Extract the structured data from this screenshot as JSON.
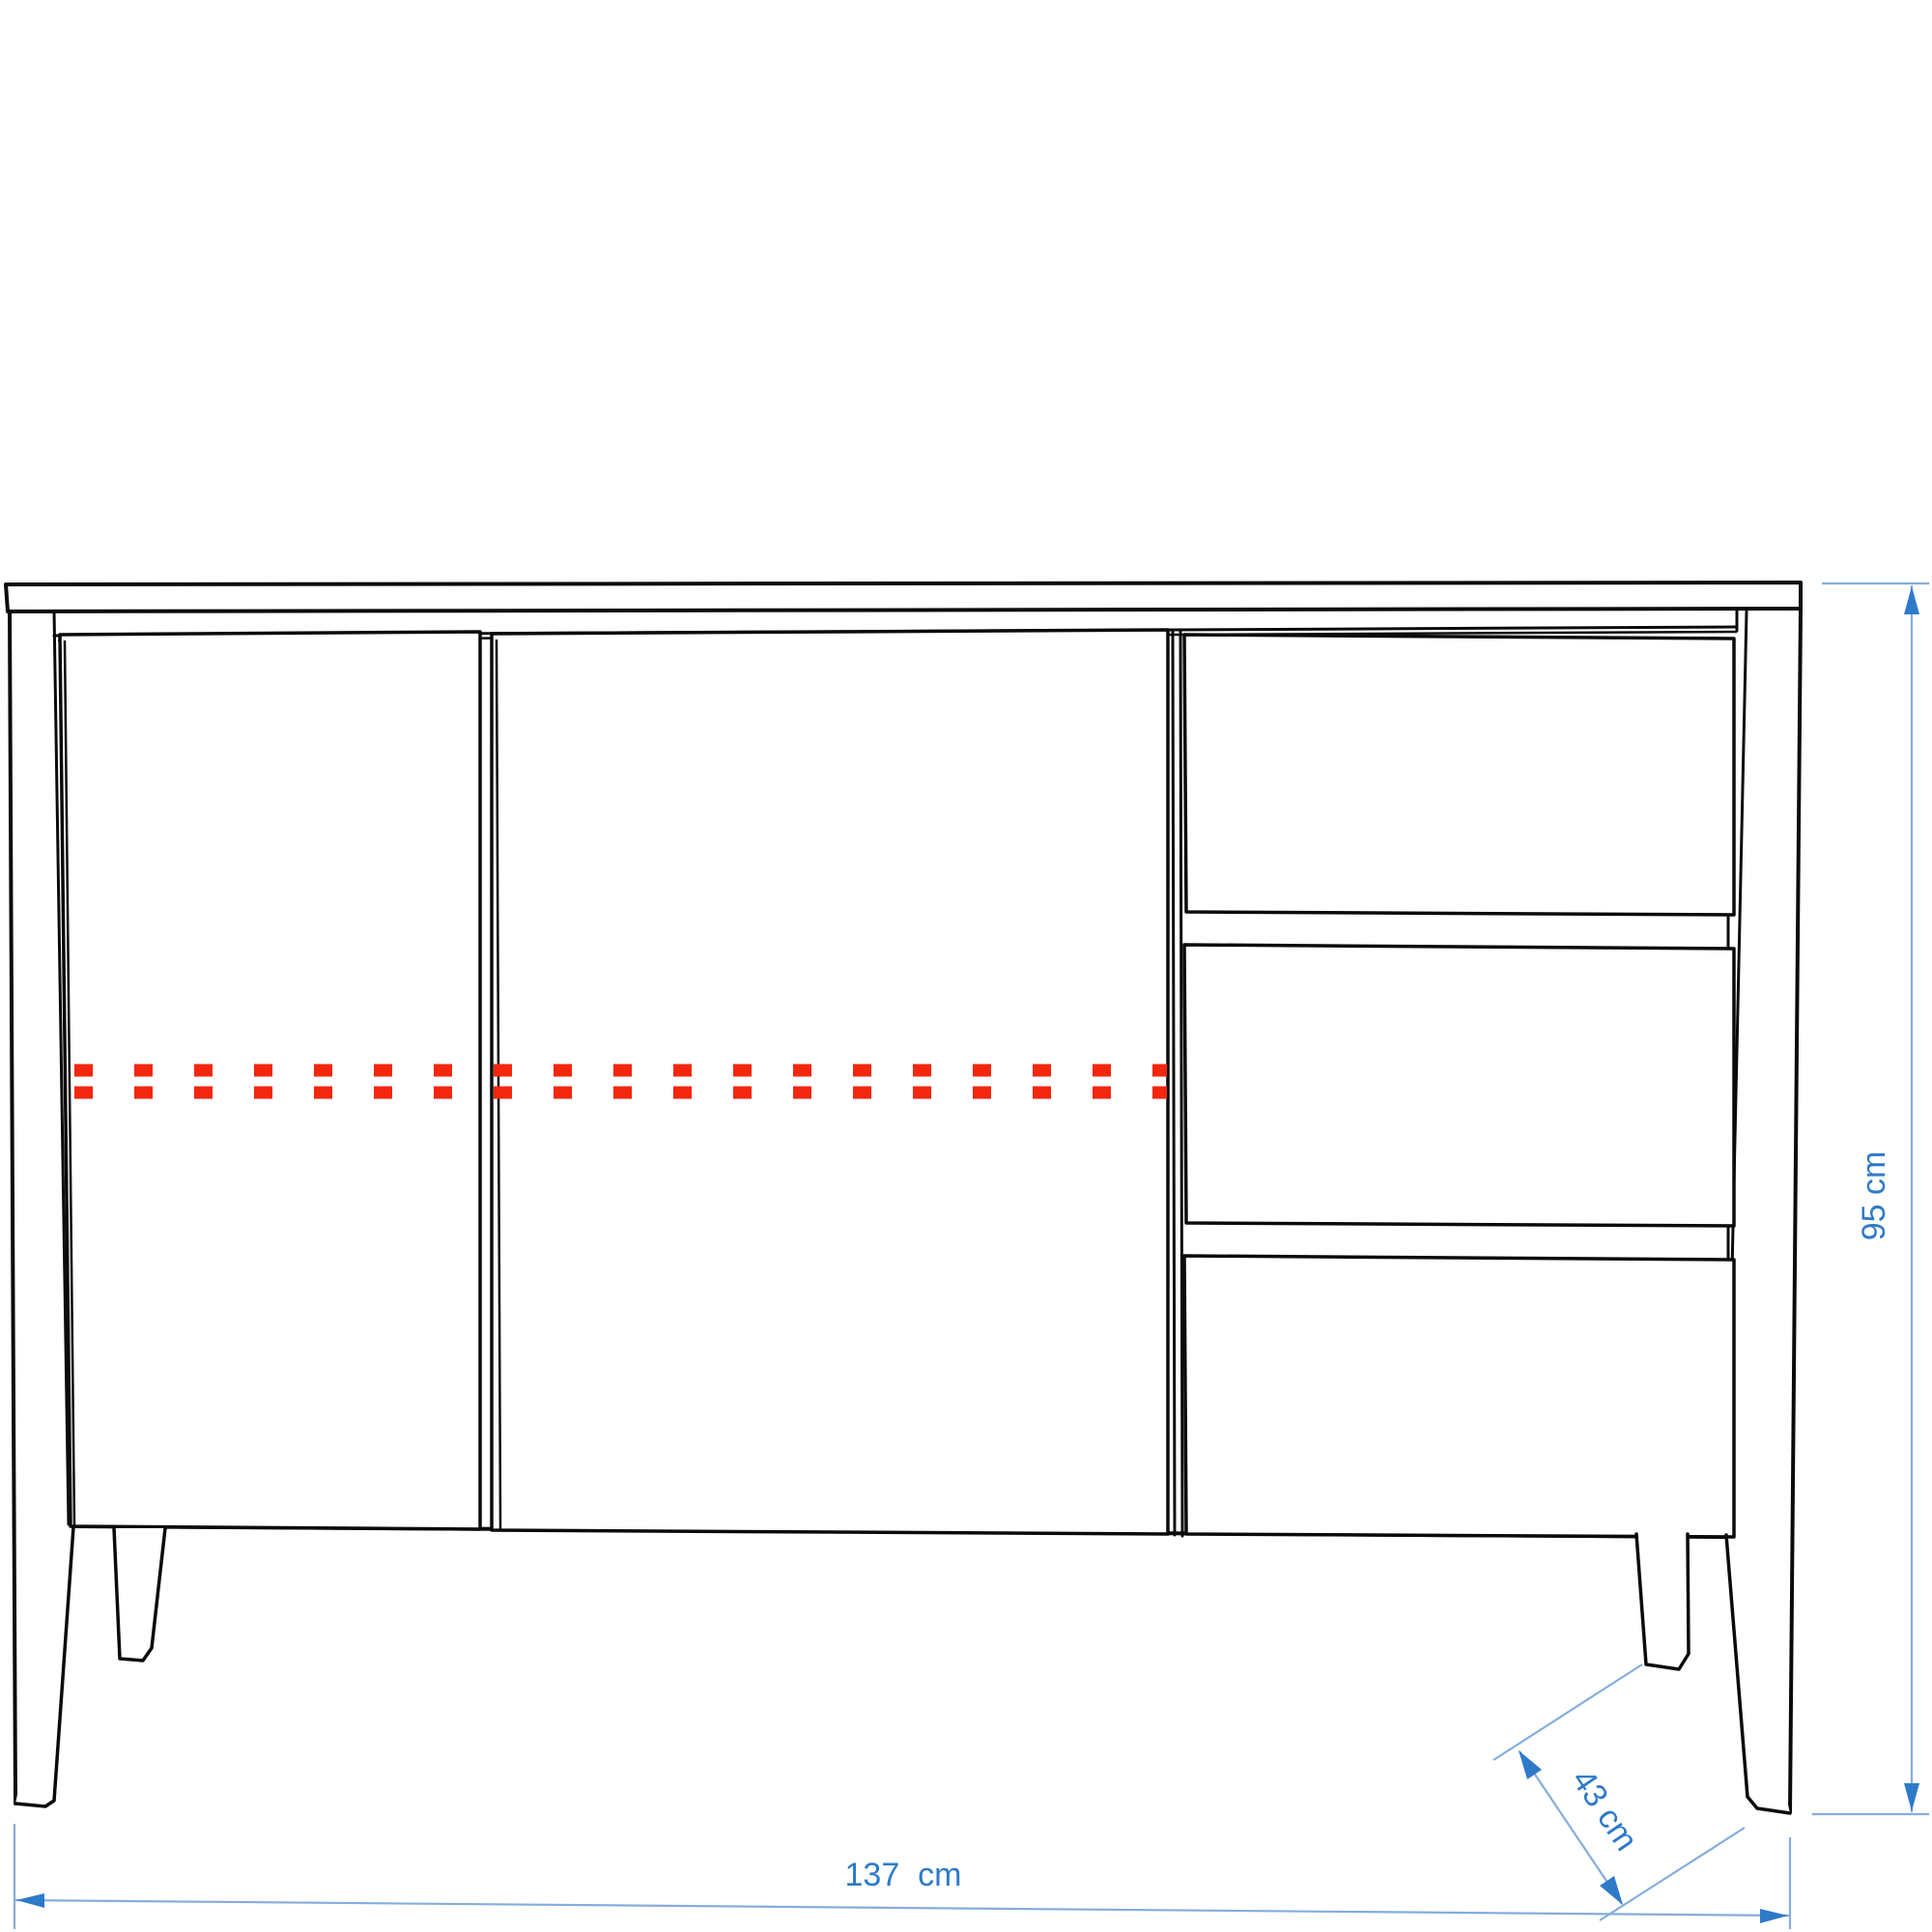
{
  "page": {
    "background": "#ffffff"
  },
  "colors": {
    "line": "#0b0b0b",
    "red": "#f3270e",
    "blue": "#2e7ac9",
    "blue_light": "#85addc"
  },
  "drawing": {
    "object": "sideboard front-view technical drawing",
    "doors": 2,
    "drawers": 3,
    "legs": 4,
    "marking": "red dashed double line across door fronts"
  },
  "dimensions": {
    "width_label": "137  cm",
    "width_value": 137,
    "width_unit": "cm",
    "height_label": "95 cm",
    "height_value": 95,
    "height_unit": "cm",
    "depth_label": "43 cm",
    "depth_value": 43,
    "depth_unit": "cm"
  }
}
